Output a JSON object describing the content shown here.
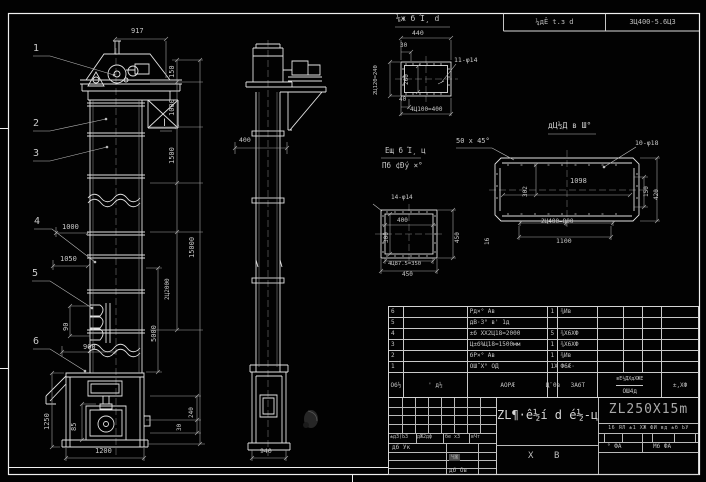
{
  "colors": {
    "bg": "#000000",
    "line": "#e2e2e2",
    "dim": "#a6a6a6",
    "text": "#c9c9c9",
    "model_text": "#a9a9a9"
  },
  "header": {
    "cells": [
      "¼дÊ t.з d",
      "3Ц400-5.6ЦЗ"
    ]
  },
  "title_block": {
    "left": {
      "cells": [
        "±дЗ(ЬЗ",
        "дЖ2дф",
        "бе хЗ",
        "вЧт"
      ],
      "row2": "дб Ук",
      "stamp": "ЧЖ",
      "bottom": "дб Ов"
    },
    "center": {
      "name": "ZL¶·ê½í d é½-ц",
      "mark1": "Х",
      "mark2": "В"
    },
    "right": {
      "model": "ZL250X15m",
      "info_row": "16 ЯЛ ±1 ХЖ ФИ вд ±б ЬУ",
      "cell_a": "° ФА",
      "cell_b": "Мб ФА"
    }
  },
  "bom": {
    "headers": [
      "Об½",
      "' д½",
      "АОРÆ",
      "Ц¨0в",
      "ЗАбТ"
    ],
    "weight_top": "вЕ½ДХдХЖЕ",
    "weight_bottom": "ОШ4д",
    "remark": "±,ХФ",
    "rows": [
      [
        "6",
        "",
        "Рд×° Ав",
        "1",
        "¾Ив",
        "",
        "",
        ""
      ],
      [
        "5",
        "",
        "дВ·З° в' 1д",
        "",
        "",
        "",
        "",
        ""
      ],
      [
        "4",
        "",
        "±б ХХ2Ц18=2000",
        "5",
        "¾Х6ХФ",
        "",
        "",
        ""
      ],
      [
        "3",
        "",
        "Ц±б%Ц18=1500мм",
        "1",
        "¾Х6ХФ",
        "",
        "",
        ""
      ],
      [
        "2",
        "",
        "бР×° Ав",
        "1",
        "¾Ив",
        "",
        "",
        ""
      ],
      [
        "1",
        "",
        "ОШ˝Х° ОД",
        "1Х",
        "Ф6Æ·",
        "",
        "",
        ""
      ]
    ]
  },
  "annotations": [
    {
      "t": "1",
      "x": 33,
      "y": 44,
      "s": 10,
      "n": "item-balloon-1"
    },
    {
      "t": "2",
      "x": 33,
      "y": 119,
      "s": 10,
      "n": "item-balloon-2"
    },
    {
      "t": "3",
      "x": 33,
      "y": 149,
      "s": 10,
      "n": "item-balloon-3"
    },
    {
      "t": "4",
      "x": 34,
      "y": 217,
      "s": 10,
      "n": "item-balloon-4"
    },
    {
      "t": "5",
      "x": 32,
      "y": 269,
      "s": 10,
      "n": "item-balloon-5"
    },
    {
      "t": "6",
      "x": 33,
      "y": 337,
      "s": 10,
      "n": "item-balloon-6"
    },
    {
      "t": "Ⅰ",
      "x": 163,
      "y": 119,
      "s": 10,
      "n": "section-mark"
    },
    {
      "t": "917",
      "x": 131,
      "y": 28,
      "n": "dim-917"
    },
    {
      "t": "150",
      "x": 169,
      "y": 78,
      "r": 1,
      "n": "dim-150"
    },
    {
      "t": "1000",
      "x": 169,
      "y": 116,
      "r": 1,
      "n": "dim-1000"
    },
    {
      "t": "1500",
      "x": 169,
      "y": 164,
      "r": 1,
      "n": "dim-1500"
    },
    {
      "t": "2Ц2000",
      "x": 165,
      "y": 300,
      "r": 1,
      "s": 6,
      "n": "dim-2x2000"
    },
    {
      "t": "5000",
      "x": 151,
      "y": 342,
      "r": 1,
      "n": "dim-5000"
    },
    {
      "t": "15000",
      "x": 189,
      "y": 258,
      "r": 1,
      "n": "dim-15000"
    },
    {
      "t": "1000",
      "x": 62,
      "y": 224,
      "n": "dim-1000-left"
    },
    {
      "t": "1050",
      "x": 60,
      "y": 256,
      "n": "dim-1050"
    },
    {
      "t": "90",
      "x": 63,
      "y": 331,
      "r": 1,
      "n": "dim-90"
    },
    {
      "t": "900",
      "x": 83,
      "y": 344,
      "n": "dim-900"
    },
    {
      "t": "1250",
      "x": 44,
      "y": 430,
      "r": 1,
      "n": "dim-1250"
    },
    {
      "t": "85",
      "x": 71,
      "y": 431,
      "r": 1,
      "n": "dim-85"
    },
    {
      "t": "1200",
      "x": 95,
      "y": 448,
      "n": "dim-1200"
    },
    {
      "t": "240",
      "x": 189,
      "y": 418,
      "r": 1,
      "s": 6,
      "n": "dim-240"
    },
    {
      "t": "30",
      "x": 177,
      "y": 431,
      "r": 1,
      "s": 6,
      "n": "dim-30"
    },
    {
      "t": "400",
      "x": 239,
      "y": 137,
      "s": 6.5,
      "n": "dim-400-side"
    },
    {
      "t": "940",
      "x": 260,
      "y": 448,
      "s": 6.5,
      "n": "dim-940"
    },
    {
      "t": "⅛ж б Ί¸ d",
      "x": 396,
      "y": 15,
      "s": 8,
      "n": "detail-a-title"
    },
    {
      "t": "440",
      "x": 412,
      "y": 30,
      "s": 6.5,
      "n": "dim-440"
    },
    {
      "t": "30",
      "x": 400,
      "y": 43,
      "s": 6,
      "n": "dim-30-flange"
    },
    {
      "t": "11-φ14",
      "x": 454,
      "y": 57,
      "s": 6.5,
      "n": "hole-callout-11x14"
    },
    {
      "t": "2Ц120=240",
      "x": 374,
      "y": 95,
      "r": 1,
      "s": 5.5,
      "n": "dim-2x120"
    },
    {
      "t": "260",
      "x": 404,
      "y": 85,
      "r": 1,
      "s": 6,
      "n": "dim-260"
    },
    {
      "t": "40",
      "x": 399,
      "y": 97,
      "s": 6,
      "n": "dim-40"
    },
    {
      "t": "4Ц100=400",
      "x": 410,
      "y": 107,
      "s": 6,
      "n": "dim-4x100"
    },
    {
      "t": "50 x 45°",
      "x": 456,
      "y": 138,
      "s": 7,
      "n": "chamfer-note"
    },
    {
      "t": "Ещ б Ί¸ ц",
      "x": 385,
      "y": 147,
      "s": 7.5,
      "n": "detail-b-title"
    },
    {
      "t": "Πб ¢Đý ×°",
      "x": 382,
      "y": 162,
      "s": 7.5,
      "n": "detail-b-subtitle"
    },
    {
      "t": "14-φ14",
      "x": 391,
      "y": 195,
      "s": 6,
      "n": "hole-callout-14x14"
    },
    {
      "t": "400",
      "x": 397,
      "y": 218,
      "s": 6,
      "n": "dim-400-sq"
    },
    {
      "t": "300",
      "x": 384,
      "y": 243,
      "r": 1,
      "s": 6,
      "n": "dim-300-sq"
    },
    {
      "t": "450",
      "x": 455,
      "y": 243,
      "r": 1,
      "s": 6,
      "n": "dim-450-sq-right"
    },
    {
      "t": "4Ц87.5=350",
      "x": 388,
      "y": 262,
      "s": 5.5,
      "n": "dim-4x87"
    },
    {
      "t": "450",
      "x": 402,
      "y": 272,
      "s": 6,
      "n": "dim-450-sq-bottom"
    },
    {
      "t": "дЦ½Д в Ш°",
      "x": 548,
      "y": 122,
      "s": 8,
      "n": "detail-c-title"
    },
    {
      "t": "10-φ18",
      "x": 635,
      "y": 140,
      "s": 6.5,
      "n": "hole-callout-10x18"
    },
    {
      "t": "1098",
      "x": 570,
      "y": 178,
      "s": 7,
      "n": "dim-1098"
    },
    {
      "t": "302",
      "x": 523,
      "y": 197,
      "r": 1,
      "s": 6,
      "n": "dim-302"
    },
    {
      "t": "150",
      "x": 644,
      "y": 197,
      "r": 1,
      "s": 6,
      "n": "dim-150-plate"
    },
    {
      "t": "420",
      "x": 654,
      "y": 200,
      "r": 1,
      "s": 6,
      "n": "dim-420"
    },
    {
      "t": "16",
      "x": 485,
      "y": 245,
      "r": 1,
      "s": 6,
      "n": "dim-16"
    },
    {
      "t": "2Ц400=800",
      "x": 541,
      "y": 219,
      "s": 6,
      "n": "dim-2x400"
    },
    {
      "t": "1100",
      "x": 556,
      "y": 238,
      "s": 6.5,
      "n": "dim-1100"
    }
  ]
}
